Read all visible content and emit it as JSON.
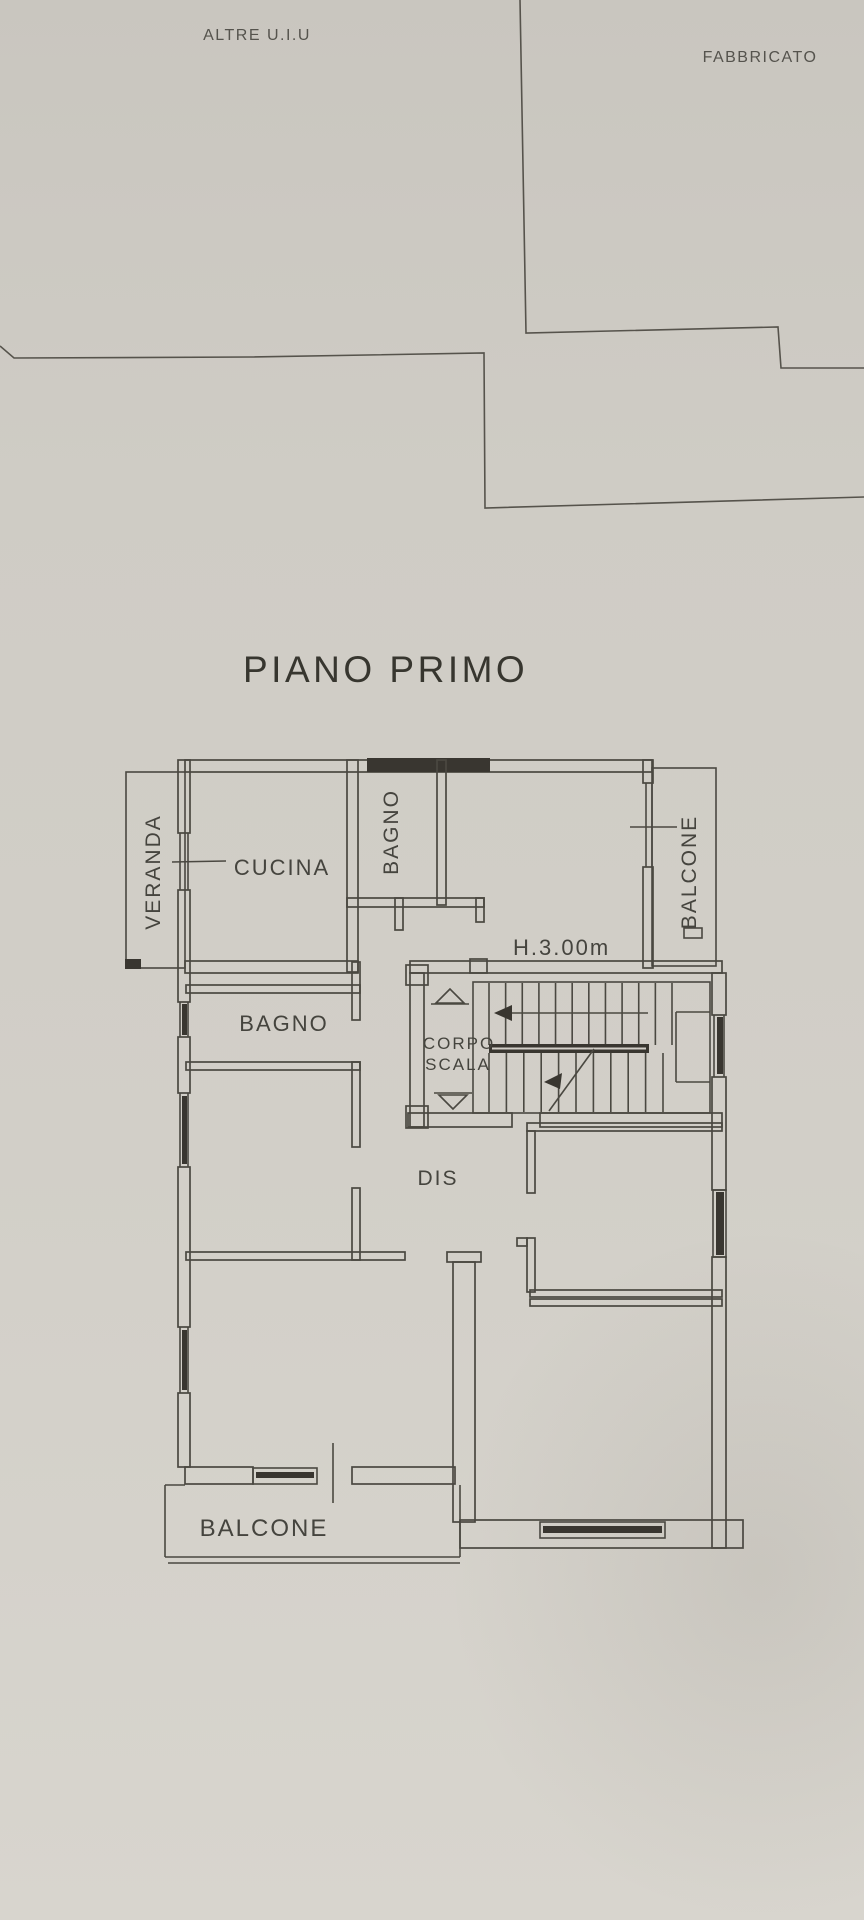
{
  "colors": {
    "paper": "#d2cfc8",
    "line": "#4a4841",
    "dark_fill": "#393630",
    "text": "#45443e"
  },
  "site": {
    "altre_uiu": "ALTRE U.I.U",
    "fabbricato": "FABBRICATO"
  },
  "title": "PIANO PRIMO",
  "plan": {
    "height_note": "H.3.00m",
    "labels": {
      "veranda": "VERANDA",
      "cucina": "CUCINA",
      "bagno_top": "BAGNO",
      "balcone_right": "BALCONE",
      "bagno_left": "BAGNO",
      "corpo": "CORPO",
      "scala": "SCALA",
      "dis": "DIS",
      "balcone_bottom": "BALCONE"
    },
    "stairs": {
      "upper": {
        "x0": 489,
        "x1": 672,
        "n": 12,
        "y0": 983,
        "y1": 1045
      },
      "lower": {
        "x0": 489,
        "x1": 663,
        "n": 11,
        "y0": 1053,
        "y1": 1112
      }
    }
  }
}
